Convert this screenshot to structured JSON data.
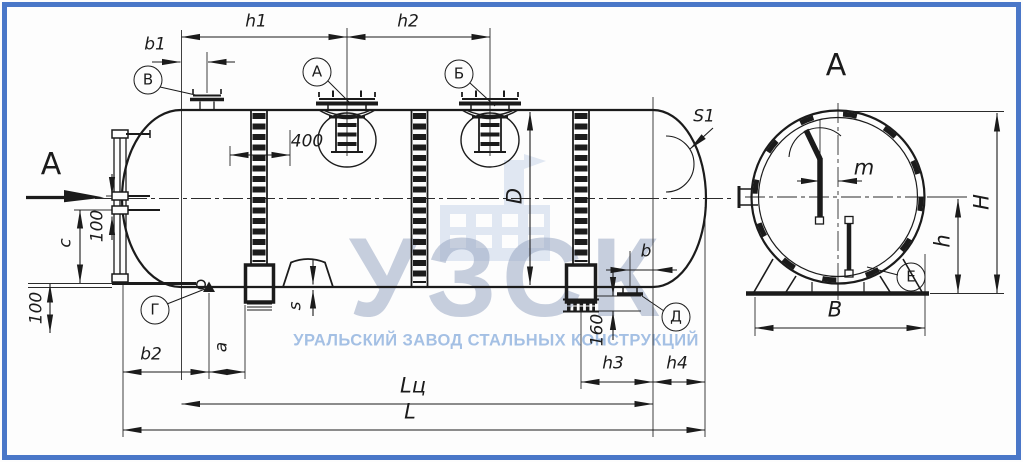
{
  "watermark": {
    "logo": "УЗСК",
    "subtitle": "УРАЛЬСКИЙ ЗАВОД СТАЛЬНЫХ КОНСТРУКЦИЙ"
  },
  "colors": {
    "frame": "#4a77c8",
    "line": "#1b1b1b",
    "wmlogo": "#9aa8c4",
    "wmtext": "#6f9bd6",
    "wmicon": "#c9d6ea"
  },
  "views": {
    "cut_letter": "А",
    "section_title": "А"
  },
  "balloons": {
    "v": "В",
    "a": "А",
    "b": "Б",
    "g": "Г",
    "d": "Д",
    "e": "Е"
  },
  "dims": {
    "h1": "h1",
    "h2": "h2",
    "b1": "b1",
    "b2": "b2",
    "n400": "400",
    "s1": "S1",
    "c": "c",
    "n100": "100",
    "a": "a",
    "s": "s",
    "d": "D",
    "b": "b",
    "n160": "160",
    "h3": "h3",
    "h4": "h4",
    "l_cyl": "Lц",
    "l_total": "L",
    "m": "m",
    "h_cap": "H",
    "h_low": "h",
    "b_cap": "В"
  }
}
